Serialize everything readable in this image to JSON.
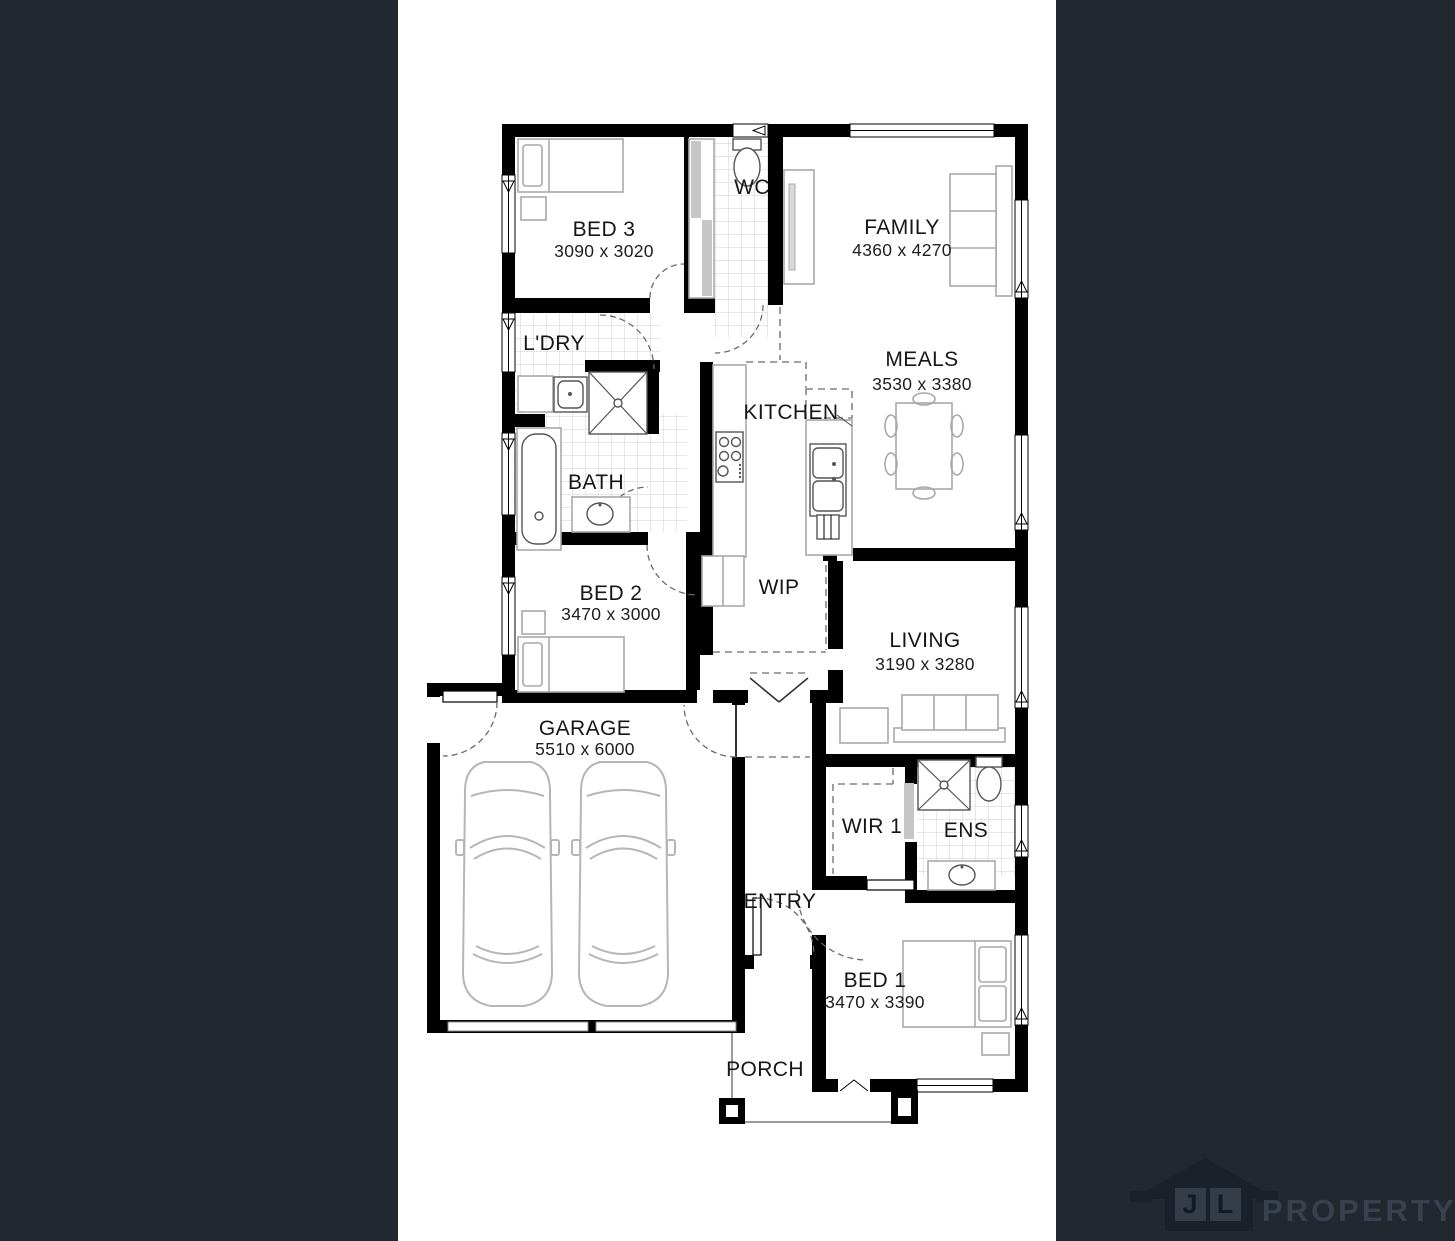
{
  "colors": {
    "background": "#212830",
    "sheet": "#FFFFFF",
    "walls": "#000000",
    "furniture_line": "#A9A9A9",
    "tile_line": "#CFCFCF",
    "logo_house": "#1A212B",
    "logo_text": "#3A414E"
  },
  "rooms": [
    {
      "id": "bed3",
      "name": "BED 3",
      "dims": "3090 x 3020"
    },
    {
      "id": "wc",
      "name": "WC"
    },
    {
      "id": "family",
      "name": "FAMILY",
      "dims": "4360 x 4270"
    },
    {
      "id": "ldry",
      "name": "L'DRY"
    },
    {
      "id": "meals",
      "name": "MEALS",
      "dims": "3530 x 3380"
    },
    {
      "id": "kitchen",
      "name": "KITCHEN"
    },
    {
      "id": "bath",
      "name": "BATH"
    },
    {
      "id": "bed2",
      "name": "BED 2",
      "dims": "3470 x 3000"
    },
    {
      "id": "wip",
      "name": "WIP"
    },
    {
      "id": "living",
      "name": "LIVING",
      "dims": "3190 x 3280"
    },
    {
      "id": "garage",
      "name": "GARAGE",
      "dims": "5510 x 6000"
    },
    {
      "id": "wir1",
      "name": "WIR 1"
    },
    {
      "id": "ens",
      "name": "ENS"
    },
    {
      "id": "entry",
      "name": "ENTRY"
    },
    {
      "id": "bed1",
      "name": "BED 1",
      "dims": "3470 x 3390"
    },
    {
      "id": "porch",
      "name": "PORCH"
    }
  ],
  "logo": {
    "letter1": "J",
    "letter2": "L",
    "brand": "PROPERTY"
  }
}
